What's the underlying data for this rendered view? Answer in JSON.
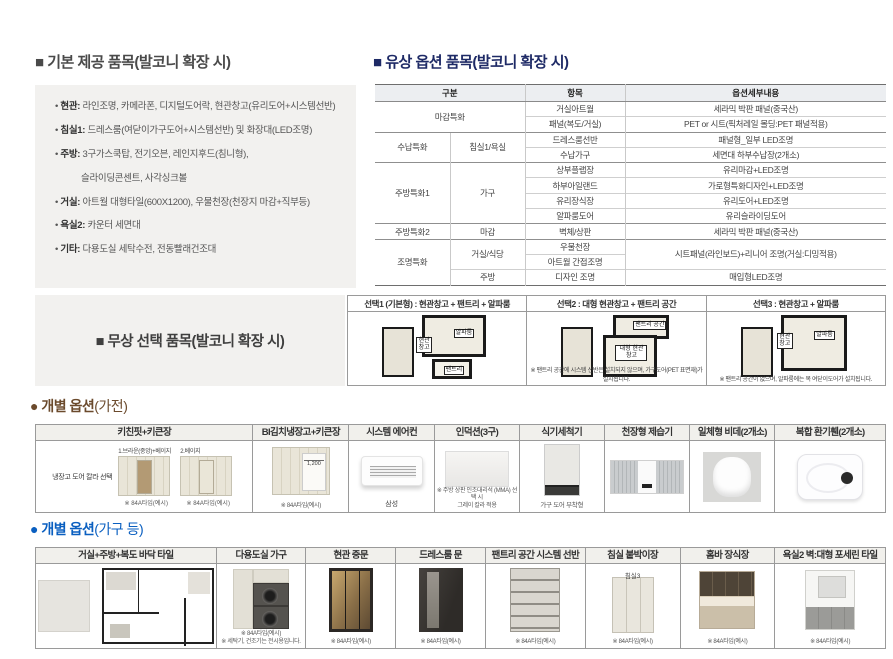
{
  "basic": {
    "title": "■ 기본 제공 품목(발코니 확장 시)",
    "items": [
      {
        "label": "현관:",
        "text": "라인조명, 카메라폰, 디지털도어락, 현관창고(유리도어+시스템선반)"
      },
      {
        "label": "침실1:",
        "text": "드레스룸(여닫이가구도어+시스템선반) 및 화장대(LED조명)"
      },
      {
        "label": "주방:",
        "text": "3구가스쿡탑, 전기오븐, 레인지후드(침니형),"
      },
      {
        "label": "",
        "text": "슬라이딩콘센트, 사각싱크볼"
      },
      {
        "label": "거실:",
        "text": "아트월 대형타일(600X1200), 우물천장(천장지 마감+직부등)"
      },
      {
        "label": "욕실2:",
        "text": "카운터 세면대"
      },
      {
        "label": "기타:",
        "text": "다용도실 세탁수전, 전동빨래건조대"
      }
    ]
  },
  "paid": {
    "title": "■ 유상 옵션 품목(발코니 확장 시)",
    "headers": [
      "구분",
      "항목",
      "옵션세부내용"
    ],
    "cells": {
      "r1g": "마감특화",
      "r1i": "거실아트월",
      "r1d": "세라믹 박판 패널(중국산)",
      "r2i": "패널(복도/거실)",
      "r2d": "PET or 시트(픽처레일 몰딩:PET 패널적용)",
      "r3g": "수납특화",
      "r3s": "침실1/욕실",
      "r3i": "드레스룸선반",
      "r3d": "패널형_일부 LED조명",
      "r4i": "수납가구",
      "r4d": "세면대 하부수납장(2개소)",
      "r5g": "주방특화1",
      "r5s": "가구",
      "r5i": "상부플랩장",
      "r5d": "유리마감+LED조명",
      "r6i": "하부아일랜드",
      "r6d": "가로형특화디자인+LED조명",
      "r7i": "유리장식장",
      "r7d": "유리도어+LED조명",
      "r8i": "알파룸도어",
      "r8d": "유리슬라이딩도어",
      "r9g": "주방특화2",
      "r9s": "마감",
      "r9i": "벽체/상판",
      "r9d": "세라믹 박판 패널(중국산)",
      "r10g": "조명특화",
      "r10s": "거실/식당",
      "r10i": "우물천장",
      "r10d": "시트패널(라인보드)+리니어 조명(거실:디밍적용)",
      "r11i": "아트월 간접조명",
      "r12s": "주방",
      "r12i": "디자인 조명",
      "r12d": "매입형LED조명"
    }
  },
  "free": {
    "title": "■ 무상 선택 품목(발코니 확장 시)",
    "options": [
      {
        "header": "선택1 (기본형) : 현관창고 + 팬트리 + 알파룸",
        "labels": [
          "알파룸",
          "현관창고",
          "팬트리"
        ],
        "note": ""
      },
      {
        "header": "선택2 : 대형 현관창고 + 팬트리 공간",
        "labels": [
          "팬트리 공간",
          "대형 현관창고"
        ],
        "note": "※ 팬트리 공간에 시스템 선반은 설치되지 않으며, 가구도어(PET 표면재)가 설치됩니다."
      },
      {
        "header": "선택3 : 현관창고 + 알파룸",
        "labels": [
          "현관창고",
          "알파룸"
        ],
        "note": "※ 팬트리 공간이 없으며, 알파룸에는 목 여닫이도어가 설치됩니다."
      }
    ]
  },
  "appliances": {
    "title_main": "● 개별 옵션",
    "title_paren": "(가전)",
    "cols": [
      {
        "header": "키친핏+키큰장",
        "left_note": "냉장고 도어 칼라 선택",
        "variants": [
          {
            "caption": "1.브라운(중앙)+베이지",
            "note": "※ 84A타입(예시)"
          },
          {
            "caption": "2.베이지",
            "note": "※ 84A타입(예시)"
          }
        ]
      },
      {
        "header": "BI김치냉장고+키큰장",
        "dim": "1,200",
        "note": "※ 84A타입(예시)"
      },
      {
        "header": "시스템 에어컨",
        "caption": "삼성"
      },
      {
        "header": "인덕션(3구)",
        "note1": "※ 주방 상판 인조대리석 (MMA) 선택 시",
        "note2": "그레이 칼라 적용"
      },
      {
        "header": "식기세척기",
        "caption": "가구 도어 부착형"
      },
      {
        "header": "천장형 제습기"
      },
      {
        "header": "일체형 비데(2개소)"
      },
      {
        "header": "복합 환기휀(2개소)"
      }
    ]
  },
  "furniture": {
    "title_main": "● 개별 옵션",
    "title_paren": "(가구 등)",
    "cols": [
      {
        "header": "거실+주방+복도 바닥 타일"
      },
      {
        "header": "다용도실 가구",
        "note1": "※ 84A타입(예시)",
        "note2": "※ 세탁기, 건조기는 전시용입니다."
      },
      {
        "header": "현관 중문",
        "note": "※ 84A타입(예시)"
      },
      {
        "header": "드레스룸 문",
        "note": "※ 84A타입(예시)"
      },
      {
        "header": "팬트리 공간 시스템 선반",
        "note": "※ 84A타입(예시)"
      },
      {
        "header": "침실 붙박이장",
        "caption": "침실3",
        "note": "※ 84A타입(예시)"
      },
      {
        "header": "홈바 장식장",
        "note": "※ 84A타입(예시)"
      },
      {
        "header": "욕실2 벽:대형 포세린 타일",
        "note": "※ 84A타입(예시)"
      }
    ]
  }
}
